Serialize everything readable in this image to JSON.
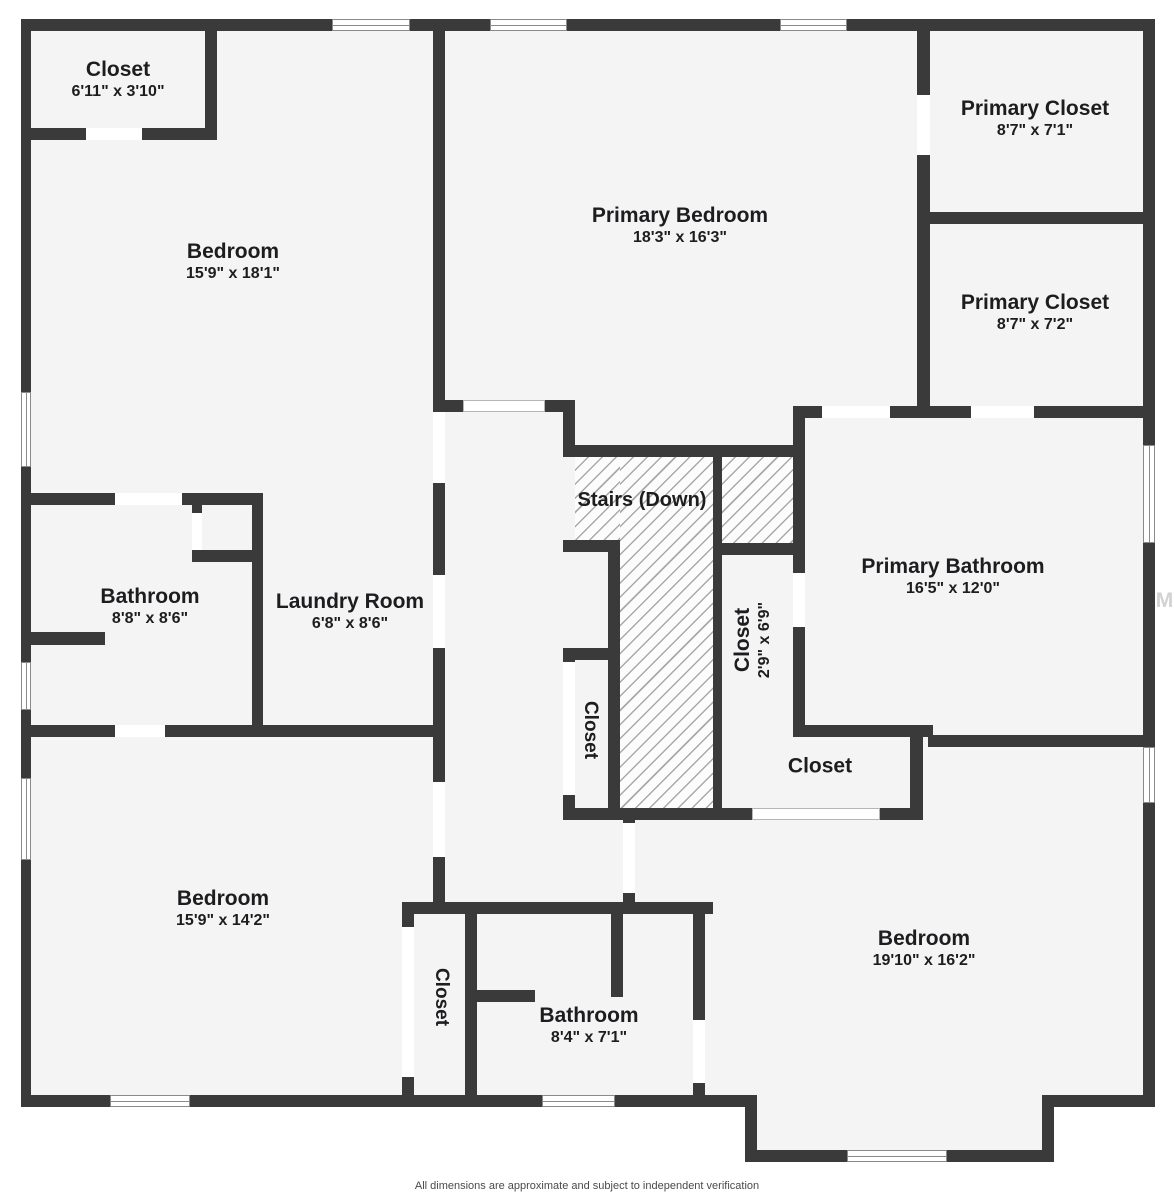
{
  "meta": {
    "footer": "All dimensions are approximate and subject to independent verification",
    "watermark": "StellarMLS"
  },
  "colors": {
    "wall": "#3a3a3b",
    "floor": "#f4f4f5",
    "door": "#ffffff",
    "door_outline": "#b5b5b5",
    "window_border": "#8a8a8a",
    "hatch_bg": "#fcfcfc",
    "hatch_line": "#a9a9a9",
    "label": "#1d1d1f",
    "footer": "#4a4a4a",
    "watermark": "#d2d2d4"
  },
  "plan": {
    "footprint": [
      {
        "x": 21,
        "y": 19,
        "w": 1134,
        "h": 1088
      },
      {
        "x": 745,
        "y": 1095,
        "w": 309,
        "h": 67
      }
    ],
    "walls": [
      [
        21,
        19,
        1134,
        12
      ],
      [
        21,
        19,
        10,
        1088
      ],
      [
        1143,
        19,
        12,
        1088
      ],
      [
        21,
        1095,
        736,
        12
      ],
      [
        745,
        1107,
        12,
        55
      ],
      [
        745,
        1150,
        309,
        12
      ],
      [
        1042,
        1095,
        12,
        67
      ],
      [
        1042,
        1095,
        113,
        12
      ],
      [
        21,
        128,
        196,
        12
      ],
      [
        205,
        19,
        12,
        121
      ],
      [
        433,
        31,
        12,
        871
      ],
      [
        21,
        493,
        242,
        12
      ],
      [
        192,
        505,
        10,
        57
      ],
      [
        192,
        550,
        71,
        12
      ],
      [
        252,
        493,
        11,
        244
      ],
      [
        21,
        632,
        84,
        13
      ],
      [
        21,
        725,
        424,
        12
      ],
      [
        433,
        400,
        142,
        12
      ],
      [
        563,
        412,
        12,
        45
      ],
      [
        563,
        445,
        242,
        12
      ],
      [
        713,
        445,
        9,
        375
      ],
      [
        563,
        540,
        57,
        12
      ],
      [
        608,
        540,
        12,
        280
      ],
      [
        563,
        648,
        45,
        12
      ],
      [
        563,
        648,
        12,
        172
      ],
      [
        713,
        543,
        92,
        12
      ],
      [
        793,
        406,
        12,
        331
      ],
      [
        793,
        406,
        350,
        12
      ],
      [
        917,
        19,
        13,
        399
      ],
      [
        917,
        212,
        226,
        12
      ],
      [
        793,
        725,
        140,
        12
      ],
      [
        928,
        735,
        215,
        12
      ],
      [
        563,
        808,
        360,
        12
      ],
      [
        910,
        737,
        13,
        83
      ],
      [
        623,
        818,
        12,
        87
      ],
      [
        402,
        902,
        311,
        12
      ],
      [
        402,
        902,
        12,
        193
      ],
      [
        465,
        914,
        12,
        181
      ],
      [
        477,
        990,
        58,
        12
      ],
      [
        611,
        914,
        12,
        83
      ],
      [
        693,
        902,
        12,
        193
      ]
    ],
    "doors": [
      {
        "x": 86,
        "y": 128,
        "w": 56,
        "h": 12
      },
      {
        "x": 433,
        "y": 412,
        "w": 12,
        "h": 71
      },
      {
        "x": 192,
        "y": 513,
        "w": 10,
        "h": 37
      },
      {
        "x": 115,
        "y": 493,
        "w": 67,
        "h": 12
      },
      {
        "x": 433,
        "y": 575,
        "w": 12,
        "h": 73
      },
      {
        "x": 463,
        "y": 400,
        "w": 82,
        "h": 12,
        "outlined": true
      },
      {
        "x": 917,
        "y": 95,
        "w": 13,
        "h": 60
      },
      {
        "x": 822,
        "y": 406,
        "w": 68,
        "h": 12
      },
      {
        "x": 971,
        "y": 406,
        "w": 63,
        "h": 12
      },
      {
        "x": 793,
        "y": 573,
        "w": 12,
        "h": 54
      },
      {
        "x": 563,
        "y": 662,
        "w": 12,
        "h": 133
      },
      {
        "x": 115,
        "y": 725,
        "w": 50,
        "h": 12
      },
      {
        "x": 433,
        "y": 782,
        "w": 12,
        "h": 75
      },
      {
        "x": 752,
        "y": 808,
        "w": 128,
        "h": 12,
        "outlined": true
      },
      {
        "x": 623,
        "y": 823,
        "w": 12,
        "h": 70
      },
      {
        "x": 402,
        "y": 927,
        "w": 12,
        "h": 150
      },
      {
        "x": 693,
        "y": 1020,
        "w": 12,
        "h": 63
      }
    ],
    "windows": [
      {
        "x": 332,
        "y": 19,
        "w": 78,
        "h": 12,
        "o": "h"
      },
      {
        "x": 490,
        "y": 19,
        "w": 77,
        "h": 12,
        "o": "h"
      },
      {
        "x": 780,
        "y": 19,
        "w": 67,
        "h": 12,
        "o": "h"
      },
      {
        "x": 110,
        "y": 1095,
        "w": 80,
        "h": 12,
        "o": "h"
      },
      {
        "x": 542,
        "y": 1095,
        "w": 73,
        "h": 12,
        "o": "h"
      },
      {
        "x": 847,
        "y": 1150,
        "w": 100,
        "h": 12,
        "o": "h"
      },
      {
        "x": 21,
        "y": 392,
        "w": 10,
        "h": 75,
        "o": "v"
      },
      {
        "x": 21,
        "y": 662,
        "w": 10,
        "h": 48,
        "o": "v"
      },
      {
        "x": 21,
        "y": 778,
        "w": 10,
        "h": 82,
        "o": "v"
      },
      {
        "x": 1143,
        "y": 445,
        "w": 12,
        "h": 98,
        "o": "v"
      },
      {
        "x": 1143,
        "y": 747,
        "w": 12,
        "h": 56,
        "o": "v"
      }
    ],
    "stairs": {
      "label": "Stairs (Down)",
      "x": 642,
      "y": 501,
      "size": 20,
      "areas": [
        {
          "x": 575,
          "y": 457,
          "w": 45,
          "h": 83
        },
        {
          "x": 620,
          "y": 457,
          "w": 93,
          "h": 351
        },
        {
          "x": 722,
          "y": 457,
          "w": 71,
          "h": 86
        }
      ]
    },
    "labels": [
      {
        "name": "Closet",
        "dims": "6'11\" x 3'10\"",
        "x": 118,
        "y": 80,
        "rot": 0
      },
      {
        "name": "Bedroom",
        "dims": "15'9\" x 18'1\"",
        "x": 233,
        "y": 262,
        "rot": 0
      },
      {
        "name": "Primary Bedroom",
        "dims": "18'3\" x 16'3\"",
        "x": 680,
        "y": 226,
        "rot": 0
      },
      {
        "name": "Primary Closet",
        "dims": "8'7\" x 7'1\"",
        "x": 1035,
        "y": 119,
        "rot": 0
      },
      {
        "name": "Primary Closet",
        "dims": "8'7\" x 7'2\"",
        "x": 1035,
        "y": 313,
        "rot": 0
      },
      {
        "name": "Bathroom",
        "dims": "8'8\" x 8'6\"",
        "x": 150,
        "y": 607,
        "rot": 0
      },
      {
        "name": "Laundry Room",
        "dims": "6'8\" x 8'6\"",
        "x": 350,
        "y": 612,
        "rot": 0
      },
      {
        "name": "Primary Bathroom",
        "dims": "16'5\" x 12'0\"",
        "x": 953,
        "y": 577,
        "rot": 0
      },
      {
        "name": "Closet",
        "dims": "2'9\" x 6'9\"",
        "x": 753,
        "y": 640,
        "rot": -90
      },
      {
        "name": "Closet",
        "x": 590,
        "y": 730,
        "rot": 90,
        "size": 19
      },
      {
        "name": "Closet",
        "x": 820,
        "y": 767,
        "rot": 0
      },
      {
        "name": "Bedroom",
        "dims": "15'9\" x 14'2\"",
        "x": 223,
        "y": 909,
        "rot": 0
      },
      {
        "name": "Closet",
        "x": 441,
        "y": 997,
        "rot": 90,
        "size": 19
      },
      {
        "name": "Bathroom",
        "dims": "8'4\" x 7'1\"",
        "x": 589,
        "y": 1026,
        "rot": 0
      },
      {
        "name": "Bedroom",
        "dims": "19'10\" x 16'2\"",
        "x": 924,
        "y": 949,
        "rot": 0
      }
    ]
  }
}
